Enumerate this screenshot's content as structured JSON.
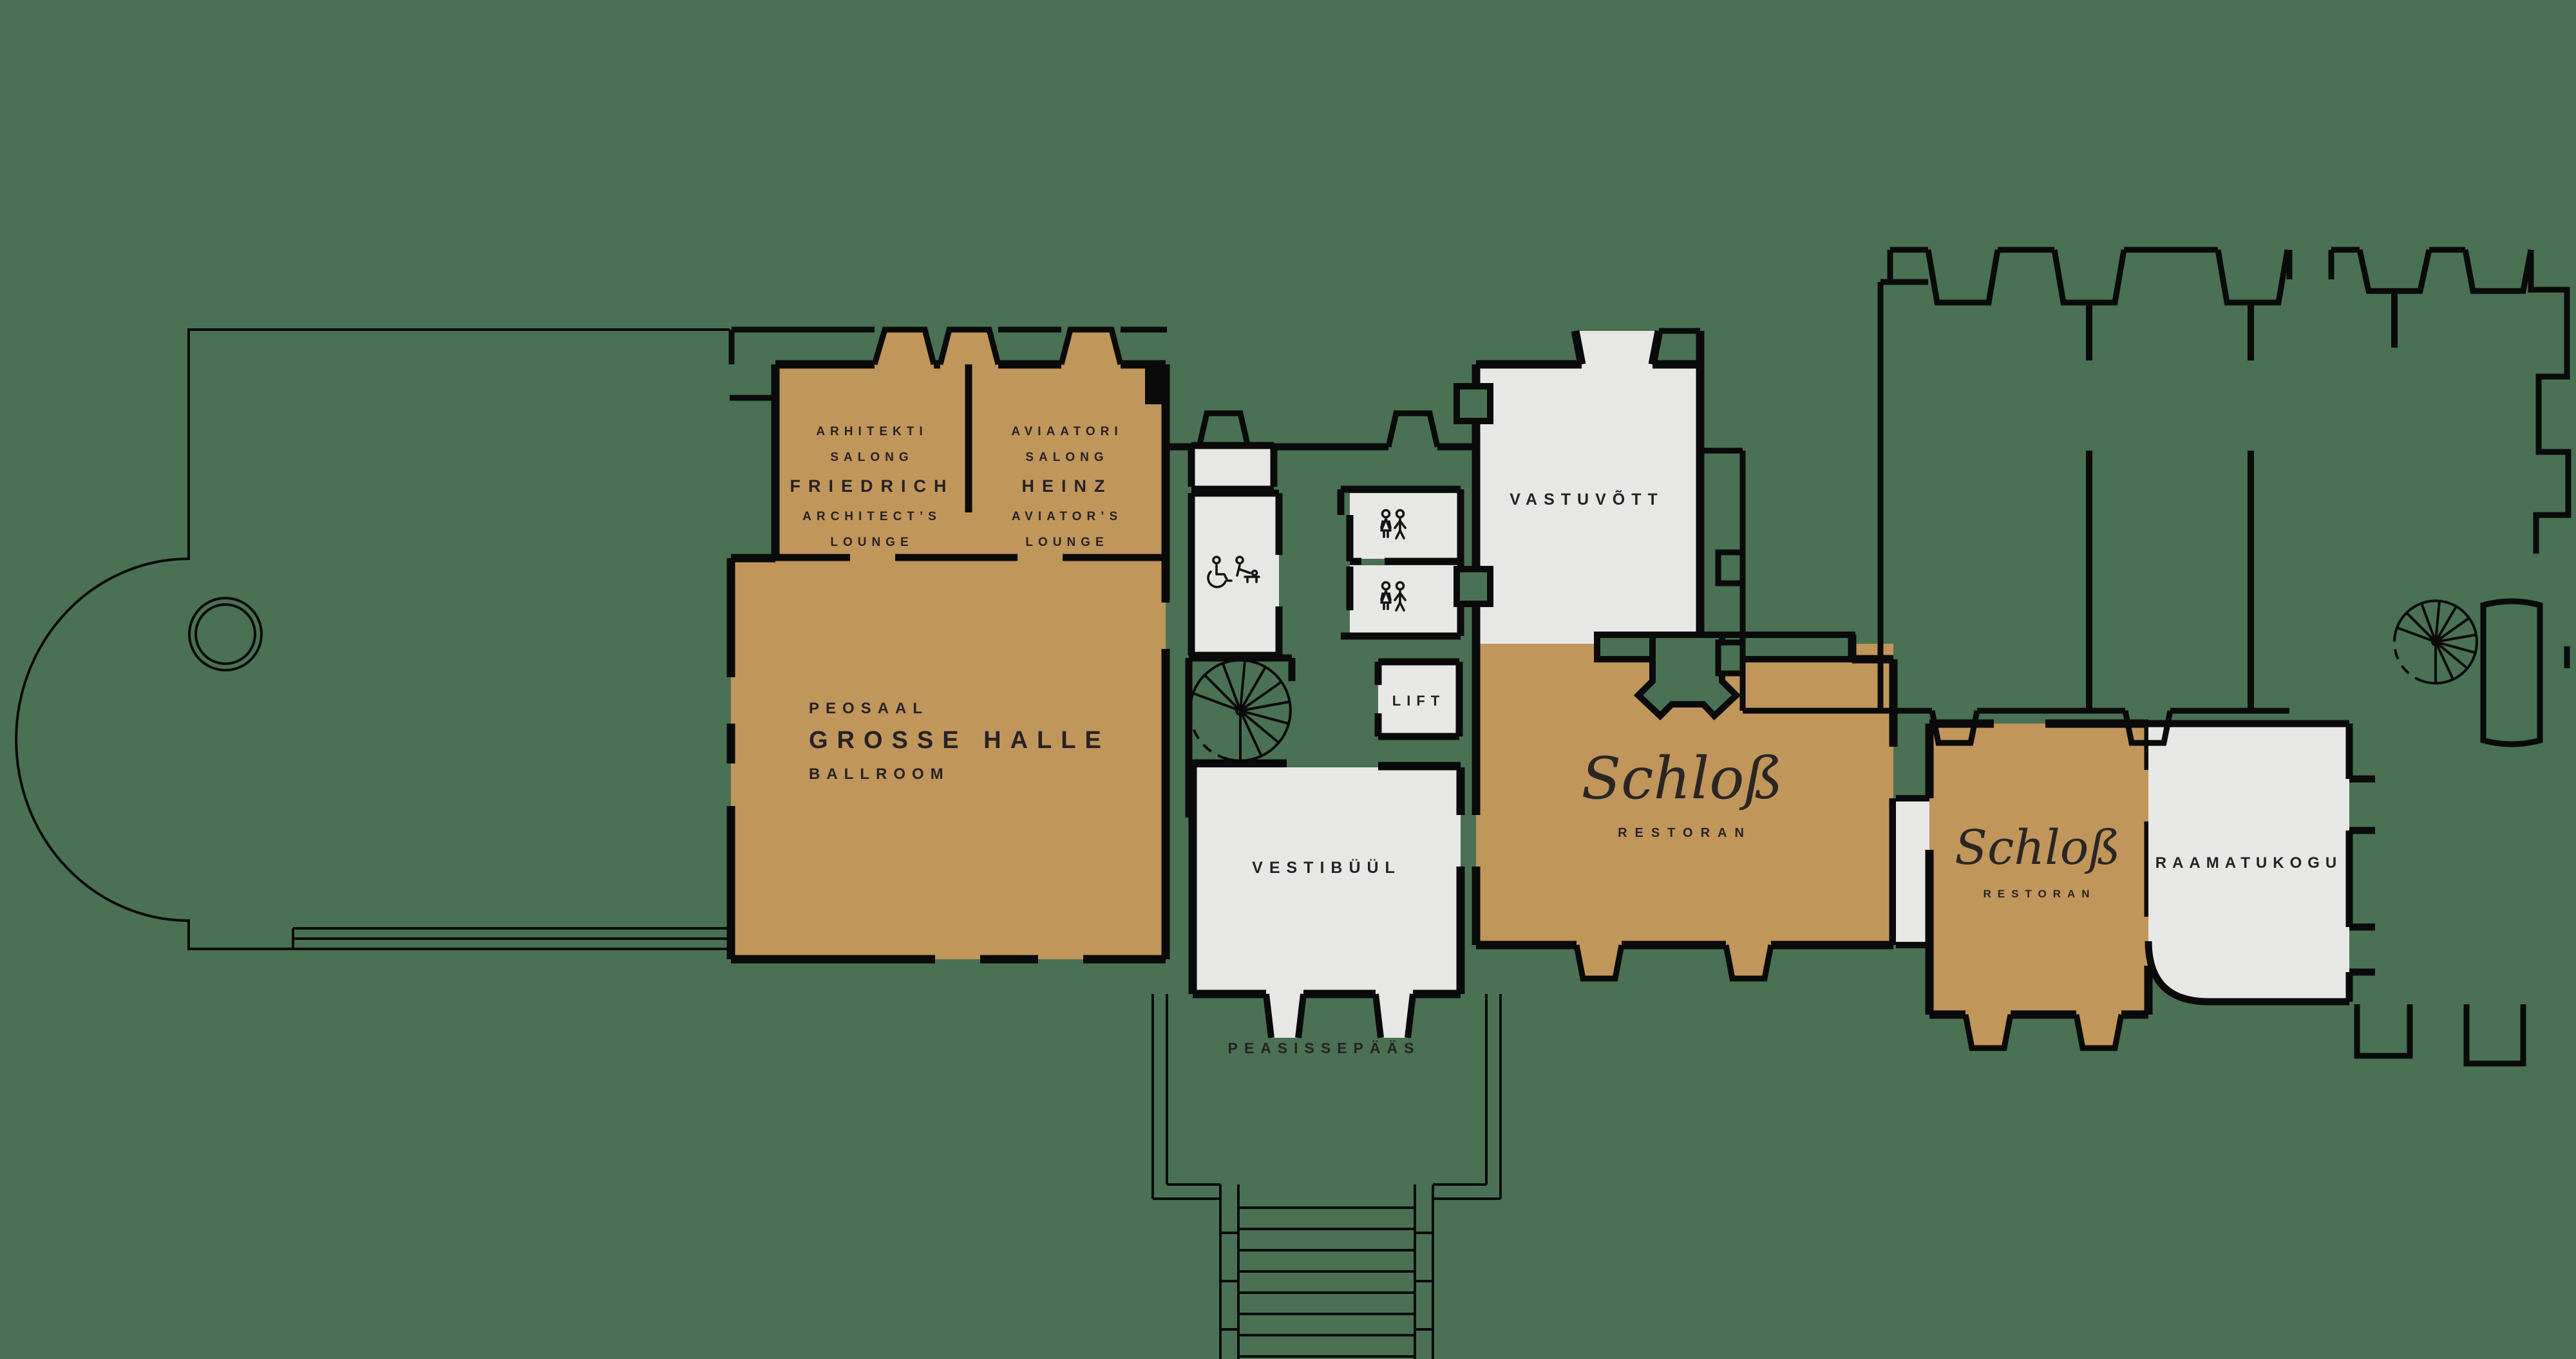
{
  "plan": {
    "title": "castle ground floor plan",
    "palette": {
      "background_green": "#4A7153",
      "room_tan": "#C0965B",
      "room_light": "#E7E7E6",
      "wall_black": "#0A0A0A",
      "label_text": "#272224"
    },
    "rooms": {
      "architects_lounge": {
        "lines": [
          "ARHITEKTI",
          "SALONG",
          "FRIEDRICH",
          "ARCHITECT’S",
          "LOUNGE"
        ]
      },
      "aviators_lounge": {
        "lines": [
          "AVIAATORI",
          "SALONG",
          "HEINZ",
          "AVIATOR’S",
          "LOUNGE"
        ]
      },
      "ballroom": {
        "lines": [
          "PEOSAAL",
          "GROSSE HALLE",
          "BALLROOM"
        ]
      },
      "vestibule": {
        "label": "VESTIBÜÜL"
      },
      "reception": {
        "label": "VASTUVÕTT"
      },
      "lift": {
        "label": "LIFT"
      },
      "restaurant_main": {
        "logo": "Schloß",
        "sub": "RESTORAN"
      },
      "restaurant_small": {
        "logo": "Schloß",
        "sub": "RESTORAN"
      },
      "library": {
        "label": "RAAMATUKOGU"
      },
      "main_entrance": {
        "label": "PEASISSEPÄÄS"
      }
    },
    "icons": {
      "accessible_wc": [
        "wheelchair-icon",
        "baby-changing-icon"
      ],
      "wc_rooms": [
        "woman-man-wc-icons",
        "woman-man-wc-icons"
      ],
      "stairs": [
        "spiral-staircase",
        "spiral-staircase"
      ],
      "terrace": "fountain-circle"
    }
  }
}
